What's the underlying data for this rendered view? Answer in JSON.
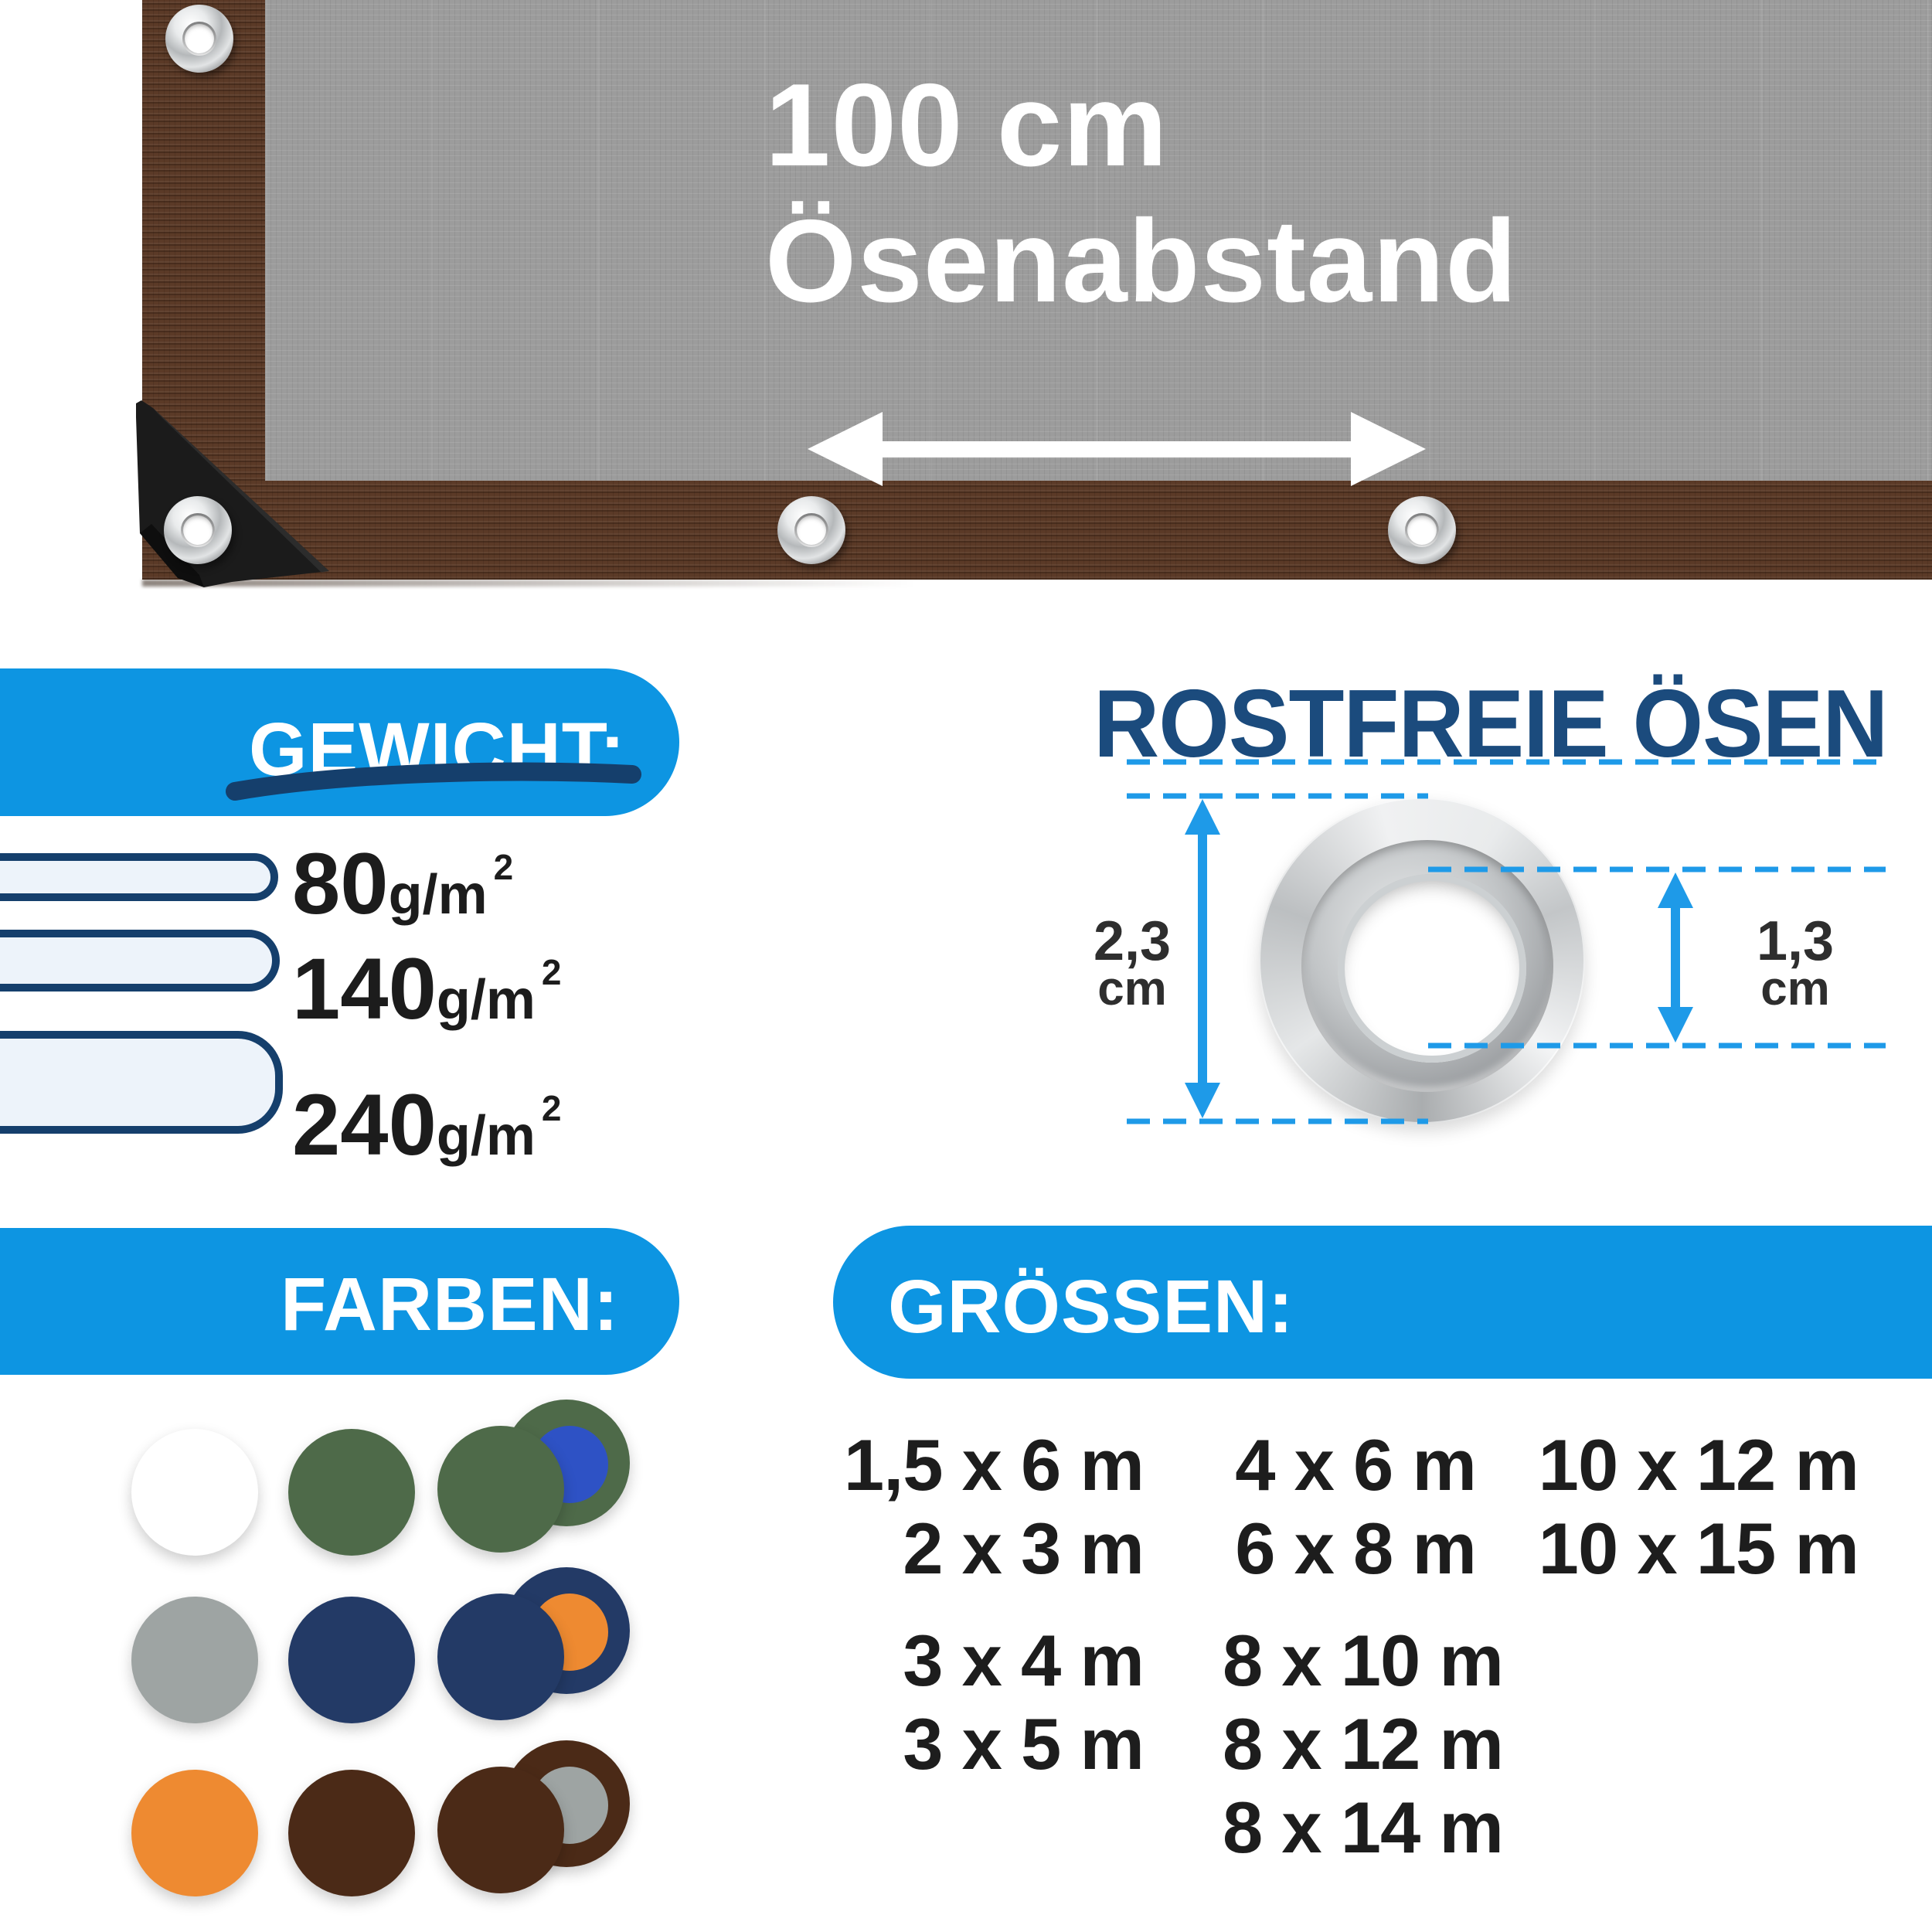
{
  "theme": {
    "pill_blue": "#0d95e2",
    "accent_navy": "#153f6c",
    "heading_navy": "#1b4b7d",
    "measure_blue": "#1e9ae8",
    "measure_text": "#2e2e2e",
    "text_black": "#1d1d1d",
    "tarp_brown": "#5b3a27",
    "tarp_gray": "#9c9c9c"
  },
  "tarp": {
    "distance_label_line1": "100 cm",
    "distance_label_line2": "Ösenabstand"
  },
  "weight": {
    "title": "GEWICHT:",
    "items": [
      {
        "value": "80",
        "unit": "g/m",
        "superscript": "2"
      },
      {
        "value": "140",
        "unit": "g/m",
        "superscript": "2"
      },
      {
        "value": "240",
        "unit": "g/m",
        "superscript": "2"
      }
    ]
  },
  "eyelets": {
    "title": "ROSTFREIE ÖSEN",
    "outer_diameter": {
      "value": "2,3",
      "unit": "cm"
    },
    "inner_diameter": {
      "value": "1,3",
      "unit": "cm"
    }
  },
  "colors_section": {
    "title": "FARBEN:",
    "swatches": [
      {
        "type": "single",
        "name": "white",
        "hex": "#ffffff"
      },
      {
        "type": "single",
        "name": "green",
        "hex": "#4e6a49"
      },
      {
        "type": "double",
        "name": "green-blue",
        "front_hex": "#4e6a49",
        "back_hex": "#4e6a49",
        "reverse_hex": "#2e52c5"
      },
      {
        "type": "single",
        "name": "gray",
        "hex": "#9ea4a3"
      },
      {
        "type": "single",
        "name": "navy",
        "hex": "#233a66"
      },
      {
        "type": "double",
        "name": "navy-orange",
        "front_hex": "#233a66",
        "back_hex": "#233a66",
        "reverse_hex": "#ee8a31"
      },
      {
        "type": "single",
        "name": "orange",
        "hex": "#ee8a31"
      },
      {
        "type": "single",
        "name": "brown",
        "hex": "#4b2a17"
      },
      {
        "type": "double",
        "name": "brown-gray",
        "front_hex": "#4b2a17",
        "back_hex": "#4b2a17",
        "reverse_hex": "#9ea4a3"
      }
    ]
  },
  "sizes_section": {
    "title": "GRÖSSEN:",
    "columns": [
      {
        "groups": [
          [
            "1,5 x 6 m",
            "2 x 3 m"
          ],
          [
            "3 x 4 m",
            "3 x 5 m"
          ]
        ]
      },
      {
        "groups": [
          [
            "4 x 6 m",
            "6 x 8 m"
          ],
          [
            "8 x 10 m",
            "8 x 12 m",
            "8 x 14 m"
          ]
        ]
      },
      {
        "groups": [
          [
            "10 x 12 m",
            "10 x 15 m"
          ]
        ]
      }
    ]
  }
}
